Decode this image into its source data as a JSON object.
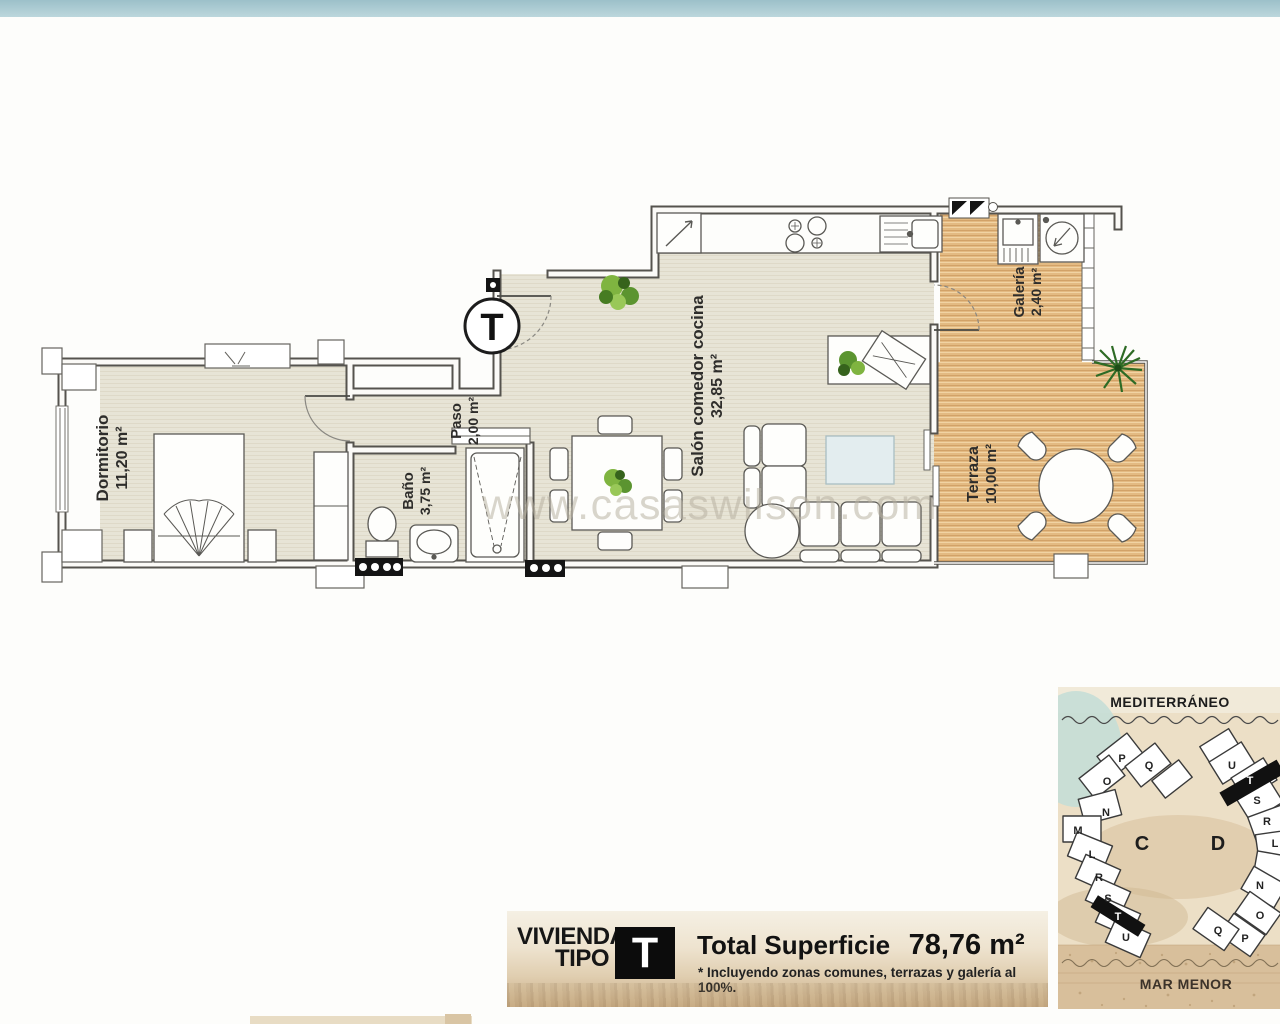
{
  "page": {
    "watermark": "www.casaswilson.com"
  },
  "plan": {
    "type_marker": "T",
    "rooms": {
      "dormitorio": {
        "name": "Dormitorio",
        "area": "11,20 m²"
      },
      "paso": {
        "name": "Paso",
        "area": "2,00 m²"
      },
      "bano": {
        "name": "Baño",
        "area": "3,75 m²"
      },
      "salon": {
        "name": "Salón comedor cocina",
        "area": "32,85 m²"
      },
      "galeria": {
        "name": "Galería",
        "area": "2,40 m²"
      },
      "terraza": {
        "name": "Terraza",
        "area": "10,00 m²"
      }
    }
  },
  "banner": {
    "dwelling_line1": "VIVIENDA",
    "dwelling_line2": "TIPO",
    "type_letter": "T",
    "total_label": "Total Superficie",
    "total_value": "78,76 m²",
    "footnote": "* Incluyendo zonas comunes, terrazas y galería al 100%."
  },
  "sitemap": {
    "sea_top": "MEDITERRÁNEO",
    "sea_bottom": "MAR MENOR",
    "block_c": {
      "label": "C",
      "units": [
        "P",
        "Q",
        "O",
        "N",
        "M",
        "L",
        "R",
        "S",
        "T",
        "U"
      ]
    },
    "block_d": {
      "label": "D",
      "units": [
        "U",
        "T",
        "S",
        "R",
        "L",
        "N",
        "O",
        "Q",
        "P"
      ]
    }
  },
  "colors": {
    "top_bar": "#aecdd4",
    "floor": "#e7e4d6",
    "wood": "#e3ba82",
    "wall": "#55534e",
    "sand": "#e4d3b5",
    "highlight_unit": "#111111"
  }
}
